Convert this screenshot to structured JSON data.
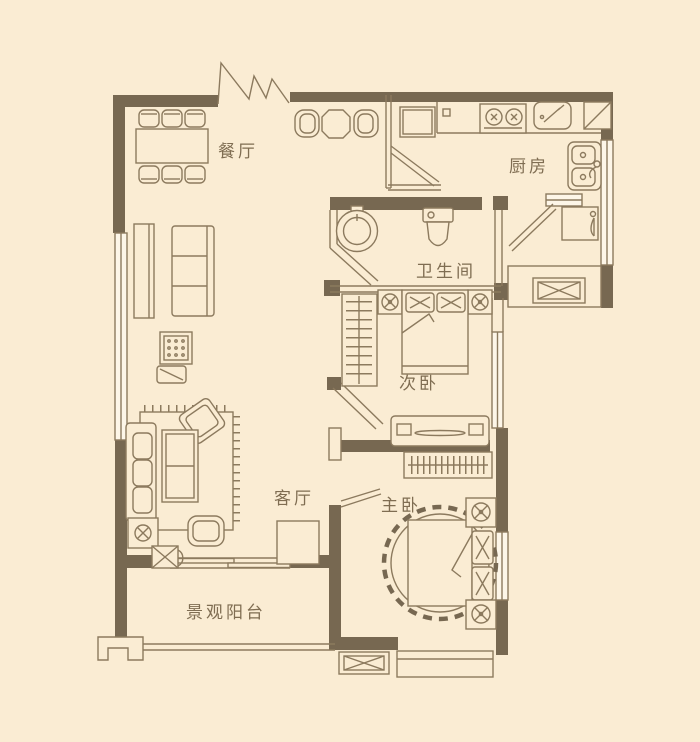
{
  "colors": {
    "background": "#faecd3",
    "wall": "#776851",
    "line": "#8c7a5e",
    "text": "#7f6d52",
    "window": "#fdf6e8"
  },
  "rooms": {
    "dining": {
      "label": "餐厅"
    },
    "kitchen": {
      "label": "厨房"
    },
    "bathroom": {
      "label": "卫生间"
    },
    "second_bedroom": {
      "label": "次卧"
    },
    "living": {
      "label": "客厅"
    },
    "master_bedroom": {
      "label": "主卧"
    },
    "balcony": {
      "label": "景观阳台"
    }
  }
}
